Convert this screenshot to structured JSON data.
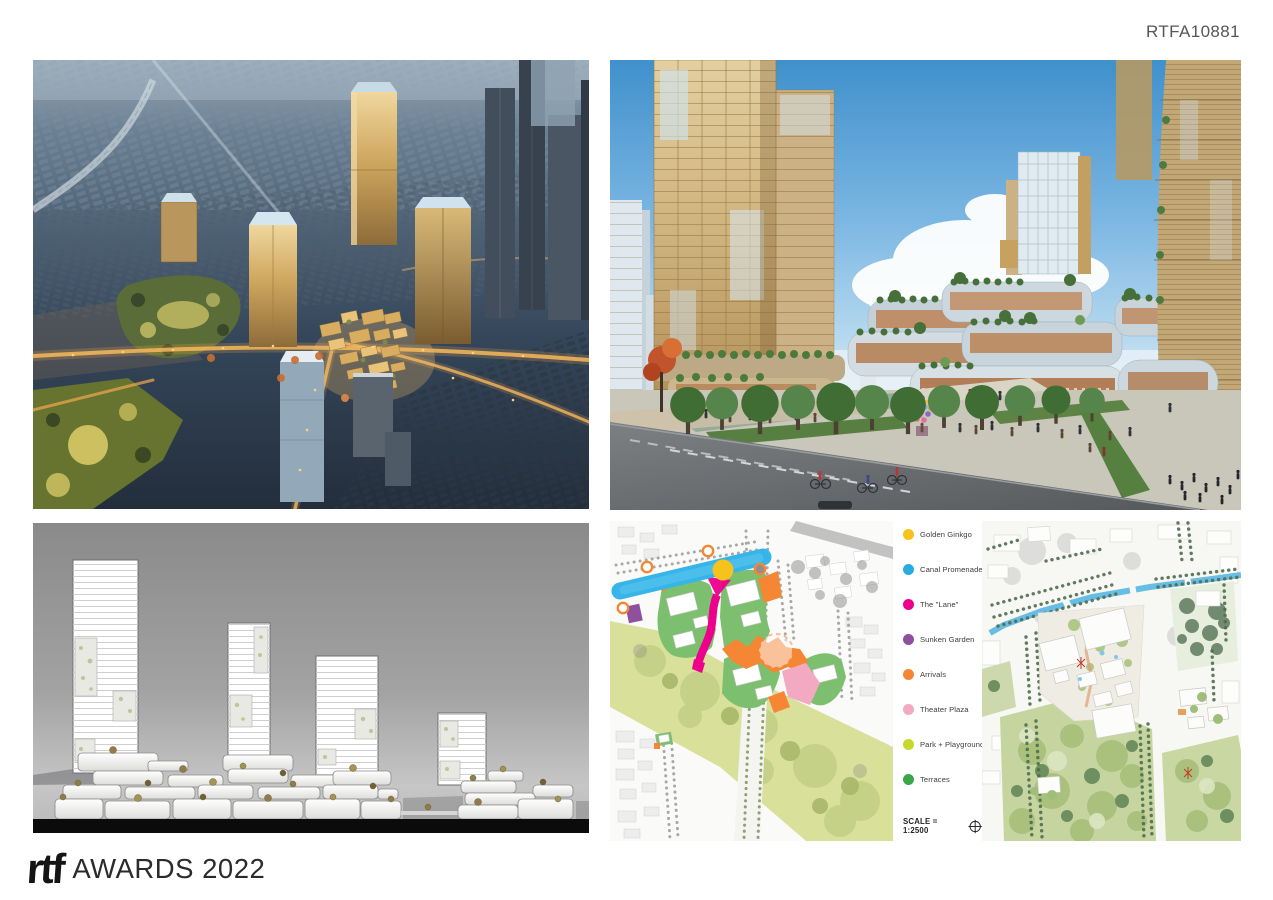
{
  "page": {
    "code": "RTFA10881"
  },
  "footer": {
    "brand": "rtf",
    "title": "AWARDS 2022"
  },
  "panels": {
    "plans": {
      "legend": {
        "items": [
          {
            "label": "Golden Ginkgo",
            "color": "#F6C21C"
          },
          {
            "label": "Canal Promenade",
            "color": "#29ABE2"
          },
          {
            "label": "The \"Lane\"",
            "color": "#EC008C"
          },
          {
            "label": "Sunken Garden",
            "color": "#8E519E"
          },
          {
            "label": "Arrivals",
            "color": "#F58634"
          },
          {
            "label": "Theater Plaza",
            "color": "#F2A9C1"
          },
          {
            "label": "Park + Playground",
            "color": "#C5D92D"
          },
          {
            "label": "Terraces",
            "color": "#3AA648"
          }
        ],
        "scale_label": "SCALE = 1:2500"
      }
    }
  }
}
